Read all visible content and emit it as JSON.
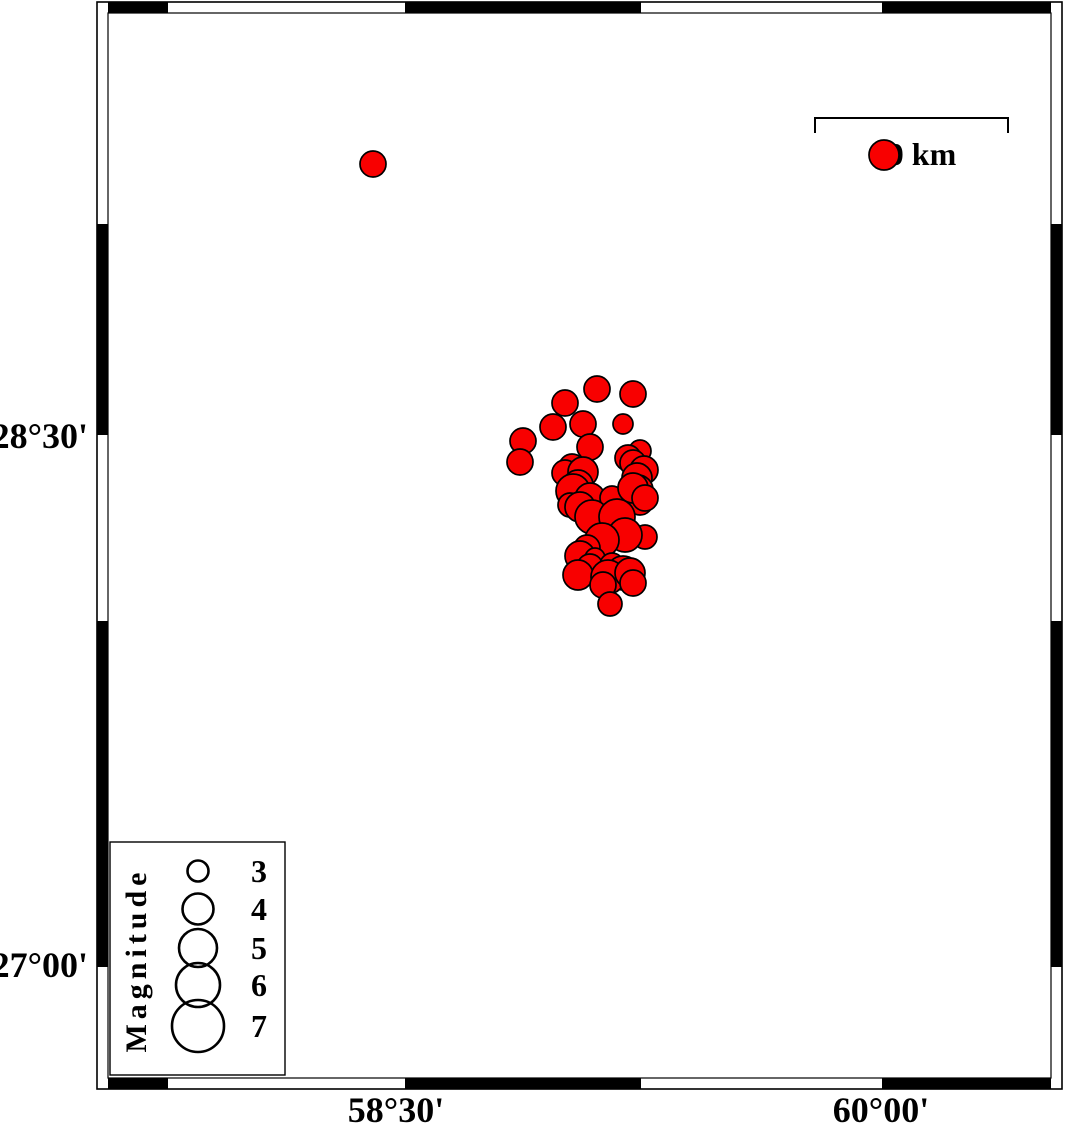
{
  "figure_title": "Earthquake epicenter map",
  "colors": {
    "background": "#ffffff",
    "quake_fill": "#f80000",
    "quake_stroke": "#000000",
    "frame_black": "#000000",
    "coastline": "#2b2b2b"
  },
  "frame": {
    "outer": {
      "x": 97,
      "y": 2,
      "x2": 1062,
      "y2": 1089
    },
    "band": 11,
    "horizontal_black_segments": [
      [
        108,
        168
      ],
      [
        405,
        641
      ],
      [
        882,
        1051
      ]
    ],
    "vertical_black_segments": [
      [
        224,
        435
      ],
      [
        621,
        967
      ]
    ]
  },
  "axis": {
    "left_labels": [
      {
        "text": "28°30'",
        "x": 88,
        "y": 448
      },
      {
        "text": "27°00'",
        "x": 88,
        "y": 977
      }
    ],
    "bottom_labels": [
      {
        "text": "58°30'",
        "x": 396,
        "y": 1122
      },
      {
        "text": "60°00'",
        "x": 881,
        "y": 1122
      }
    ]
  },
  "scalebar": {
    "label": "60 km",
    "label_x": 914,
    "label_y": 165,
    "x1": 815,
    "x2": 1008,
    "y": 118,
    "tick_drop": 15
  },
  "legend": {
    "title": "Magnitude",
    "title_x": 146,
    "title_y": 960,
    "box": {
      "x": 110,
      "y": 842,
      "w": 175,
      "h": 233
    },
    "circle_cx": 198,
    "label_x": 259,
    "entries": [
      {
        "label": "3",
        "cy": 871,
        "r": 10.5
      },
      {
        "label": "4",
        "cy": 909,
        "r": 15.5
      },
      {
        "label": "5",
        "cy": 948,
        "r": 19
      },
      {
        "label": "6",
        "cy": 985,
        "r": 22
      },
      {
        "label": "7",
        "cy": 1026,
        "r": 26
      }
    ]
  },
  "coastlines": [
    [
      [
        704,
        13
      ],
      [
        705,
        43
      ],
      [
        708,
        92
      ],
      [
        706,
        97
      ],
      [
        711,
        143
      ],
      [
        717,
        167
      ],
      [
        723,
        180
      ],
      [
        727,
        196
      ],
      [
        731,
        207
      ],
      [
        736,
        219
      ],
      [
        742,
        224
      ],
      [
        740,
        232
      ],
      [
        731,
        242
      ],
      [
        723,
        257
      ],
      [
        719,
        267
      ],
      [
        720,
        287
      ],
      [
        724,
        300
      ],
      [
        727,
        313
      ],
      [
        730,
        330
      ],
      [
        737,
        350
      ],
      [
        738,
        367
      ],
      [
        740,
        387
      ],
      [
        737,
        394
      ],
      [
        740,
        413
      ],
      [
        738,
        427
      ],
      [
        728,
        434
      ],
      [
        710,
        437
      ],
      [
        685,
        440
      ],
      [
        655,
        443
      ],
      [
        628,
        447
      ],
      [
        608,
        453
      ],
      [
        598,
        460
      ],
      [
        595,
        468
      ],
      [
        598,
        478
      ],
      [
        602,
        490
      ],
      [
        602,
        500
      ],
      [
        597,
        520
      ],
      [
        590,
        543
      ],
      [
        581,
        560
      ],
      [
        570,
        578
      ],
      [
        553,
        590
      ],
      [
        545,
        598
      ],
      [
        543,
        607
      ],
      [
        540,
        620
      ],
      [
        535,
        636
      ],
      [
        530,
        647
      ],
      [
        529,
        654
      ],
      [
        532,
        670
      ],
      [
        531,
        685
      ],
      [
        533,
        700
      ],
      [
        533,
        737
      ],
      [
        530,
        767
      ],
      [
        523,
        793
      ],
      [
        521,
        803
      ],
      [
        515,
        837
      ],
      [
        512,
        857
      ],
      [
        509,
        873
      ],
      [
        508,
        903
      ],
      [
        510,
        923
      ],
      [
        515,
        938
      ],
      [
        520,
        948
      ],
      [
        525,
        957
      ],
      [
        533,
        965
      ],
      [
        536,
        971
      ],
      [
        529,
        980
      ],
      [
        523,
        995
      ],
      [
        518,
        1012
      ],
      [
        517,
        1025
      ],
      [
        518,
        1037
      ],
      [
        528,
        1045
      ],
      [
        538,
        1047
      ],
      [
        560,
        1050
      ],
      [
        562,
        1060
      ],
      [
        563,
        1078
      ]
    ],
    [
      [
        286,
        1021
      ],
      [
        297,
        1033
      ],
      [
        308,
        1042
      ],
      [
        330,
        1048
      ],
      [
        360,
        1053
      ],
      [
        380,
        1057
      ],
      [
        394,
        1064
      ],
      [
        401,
        1071
      ],
      [
        405,
        1078
      ]
    ]
  ],
  "earthquakes": [
    {
      "x": 373,
      "y": 164,
      "r": 13
    },
    {
      "x": 884,
      "y": 155,
      "r": 15
    },
    {
      "x": 597,
      "y": 389,
      "r": 13
    },
    {
      "x": 633,
      "y": 394,
      "r": 13
    },
    {
      "x": 565,
      "y": 403,
      "r": 13
    },
    {
      "x": 583,
      "y": 424,
      "r": 13
    },
    {
      "x": 623,
      "y": 424,
      "r": 10
    },
    {
      "x": 553,
      "y": 427,
      "r": 13
    },
    {
      "x": 523,
      "y": 441,
      "r": 13
    },
    {
      "x": 520,
      "y": 462,
      "r": 13
    },
    {
      "x": 590,
      "y": 447,
      "r": 13
    },
    {
      "x": 640,
      "y": 451,
      "r": 11
    },
    {
      "x": 628,
      "y": 458,
      "r": 13
    },
    {
      "x": 633,
      "y": 463,
      "r": 13
    },
    {
      "x": 644,
      "y": 470,
      "r": 14
    },
    {
      "x": 572,
      "y": 467,
      "r": 13
    },
    {
      "x": 565,
      "y": 473,
      "r": 13
    },
    {
      "x": 583,
      "y": 472,
      "r": 15
    },
    {
      "x": 578,
      "y": 485,
      "r": 15
    },
    {
      "x": 573,
      "y": 491,
      "r": 17
    },
    {
      "x": 590,
      "y": 498,
      "r": 15
    },
    {
      "x": 612,
      "y": 498,
      "r": 12
    },
    {
      "x": 637,
      "y": 478,
      "r": 15
    },
    {
      "x": 638,
      "y": 490,
      "r": 15
    },
    {
      "x": 640,
      "y": 502,
      "r": 13
    },
    {
      "x": 633,
      "y": 488,
      "r": 15
    },
    {
      "x": 645,
      "y": 498,
      "r": 13
    },
    {
      "x": 570,
      "y": 505,
      "r": 12
    },
    {
      "x": 580,
      "y": 507,
      "r": 15
    },
    {
      "x": 592,
      "y": 517,
      "r": 17
    },
    {
      "x": 617,
      "y": 517,
      "r": 18
    },
    {
      "x": 645,
      "y": 537,
      "r": 12
    },
    {
      "x": 625,
      "y": 535,
      "r": 17
    },
    {
      "x": 602,
      "y": 540,
      "r": 17
    },
    {
      "x": 587,
      "y": 548,
      "r": 13
    },
    {
      "x": 580,
      "y": 556,
      "r": 15
    },
    {
      "x": 595,
      "y": 558,
      "r": 10
    },
    {
      "x": 590,
      "y": 567,
      "r": 13
    },
    {
      "x": 612,
      "y": 565,
      "r": 12
    },
    {
      "x": 623,
      "y": 573,
      "r": 17
    },
    {
      "x": 578,
      "y": 575,
      "r": 15
    },
    {
      "x": 608,
      "y": 577,
      "r": 17
    },
    {
      "x": 630,
      "y": 573,
      "r": 15
    },
    {
      "x": 633,
      "y": 583,
      "r": 13
    },
    {
      "x": 603,
      "y": 585,
      "r": 13
    },
    {
      "x": 610,
      "y": 604,
      "r": 12
    }
  ]
}
